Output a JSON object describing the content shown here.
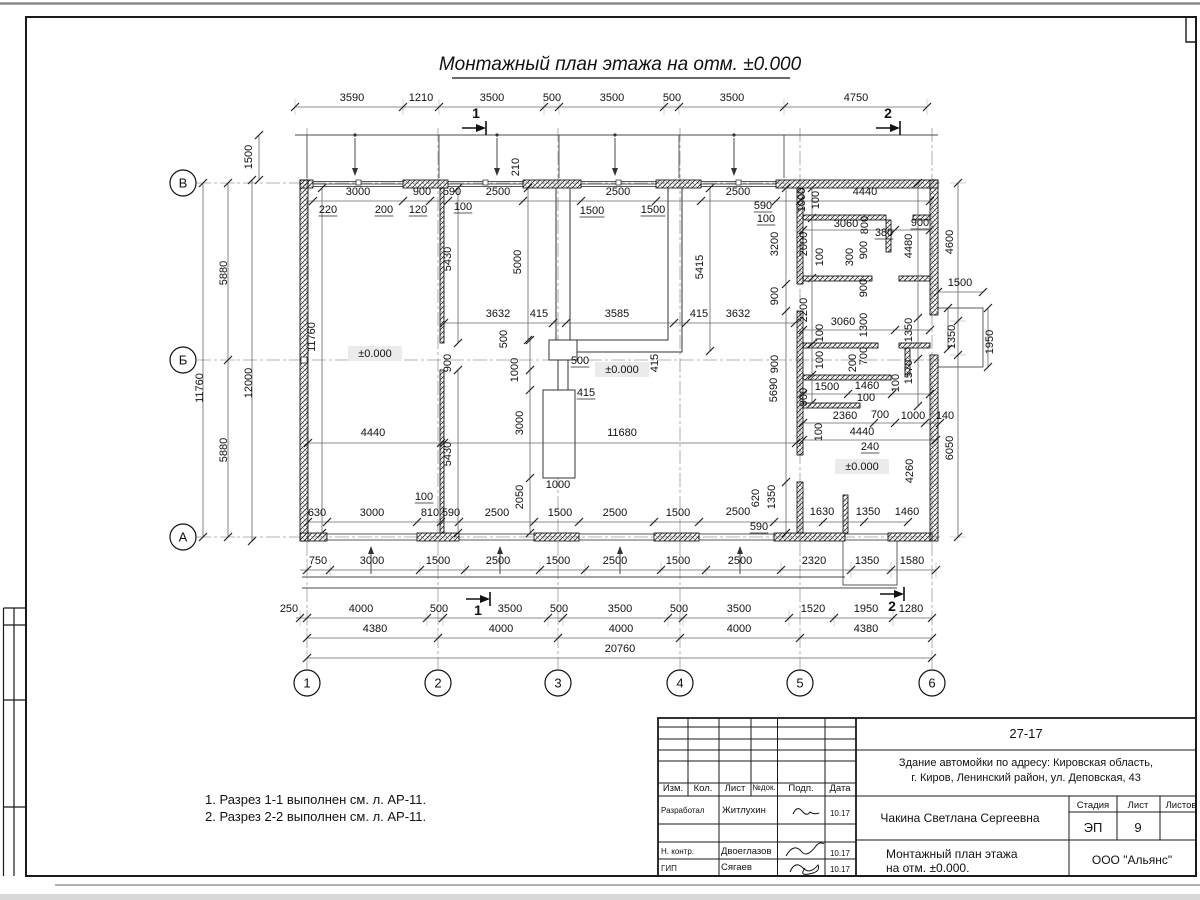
{
  "sheet": {
    "title": "Монтажный план этажа на отм. ±0.000",
    "notes": [
      "1. Разрез 1-1 выполнен см. л. АР-11.",
      "2. Разрез 2-2 выполнен см. л. АР-11."
    ]
  },
  "axes": {
    "rows": [
      {
        "label": "В",
        "x": 183,
        "y": 183
      },
      {
        "label": "Б",
        "x": 183,
        "y": 360
      },
      {
        "label": "А",
        "x": 183,
        "y": 537
      }
    ],
    "cols": [
      {
        "label": "1",
        "x": 307,
        "y": 683
      },
      {
        "label": "2",
        "x": 438,
        "y": 683
      },
      {
        "label": "3",
        "x": 558,
        "y": 683
      },
      {
        "label": "4",
        "x": 680,
        "y": 683
      },
      {
        "label": "5",
        "x": 800,
        "y": 683
      },
      {
        "label": "6",
        "x": 932,
        "y": 683
      }
    ]
  },
  "sections": [
    {
      "t": "1",
      "tx": 476,
      "ty": 118,
      "ax": 462,
      "ay": 128
    },
    {
      "t": "2",
      "tx": 888,
      "ty": 118,
      "ax": 876,
      "ay": 128
    },
    {
      "t": "1",
      "tx": 478,
      "ty": 615,
      "ax": 466,
      "ay": 599
    },
    {
      "t": "2",
      "tx": 892,
      "ty": 611,
      "ax": 880,
      "ay": 594
    }
  ],
  "levels": [
    {
      "t": "±0.000",
      "x": 375,
      "y": 357
    },
    {
      "t": "±0.000",
      "x": 622,
      "y": 373
    },
    {
      "t": "±0.000",
      "x": 862,
      "y": 470
    }
  ],
  "dims": [
    [
      "3590",
      352,
      101
    ],
    [
      "1210",
      421,
      101
    ],
    [
      "3500",
      492,
      101
    ],
    [
      "500",
      552,
      101
    ],
    [
      "3500",
      612,
      101
    ],
    [
      "500",
      672,
      101
    ],
    [
      "3500",
      732,
      101
    ],
    [
      "4750",
      856,
      101
    ],
    [
      "3000",
      358,
      195
    ],
    [
      "900",
      422,
      195
    ],
    [
      "590",
      452,
      195
    ],
    [
      "2500",
      498,
      195
    ],
    [
      "2500",
      618,
      195
    ],
    [
      "2500",
      738,
      195
    ],
    [
      "4440",
      865,
      195
    ],
    [
      "220",
      328,
      213,
      0,
      1
    ],
    [
      "200",
      384,
      213,
      0,
      1
    ],
    [
      "120",
      418,
      213,
      0,
      1
    ],
    [
      "100",
      463,
      210,
      0,
      1
    ],
    [
      "1500",
      592,
      214,
      0,
      1
    ],
    [
      "1500",
      653,
      213,
      0,
      1
    ],
    [
      "590",
      763,
      209,
      0,
      1
    ],
    [
      "100",
      766,
      222,
      0,
      1
    ],
    [
      "1000",
      805,
      200,
      1
    ],
    [
      "100",
      819,
      200,
      1
    ],
    [
      "3060",
      846,
      227
    ],
    [
      "800",
      868,
      225,
      1
    ],
    [
      "380",
      884,
      236,
      0,
      1
    ],
    [
      "900",
      920,
      226,
      0,
      1
    ],
    [
      "3200",
      778,
      244,
      1
    ],
    [
      "2000",
      807,
      244,
      1
    ],
    [
      "100",
      823,
      257,
      1
    ],
    [
      "300",
      853,
      257,
      1
    ],
    [
      "900",
      867,
      250,
      1
    ],
    [
      "4480",
      912,
      246,
      1
    ],
    [
      "4600",
      953,
      242,
      1
    ],
    [
      "900",
      778,
      296,
      1
    ],
    [
      "2200",
      807,
      310,
      1
    ],
    [
      "900",
      867,
      288,
      1
    ],
    [
      "1500",
      960,
      286
    ],
    [
      "3060",
      843,
      325
    ],
    [
      "1300",
      867,
      325,
      1
    ],
    [
      "100",
      823,
      333,
      1
    ],
    [
      "1350",
      912,
      330,
      1
    ],
    [
      "1350",
      955,
      337,
      1
    ],
    [
      "1950",
      993,
      342,
      1
    ],
    [
      "1570",
      912,
      372,
      1
    ],
    [
      "900",
      778,
      364,
      1
    ],
    [
      "100",
      823,
      360,
      1
    ],
    [
      "200",
      856,
      363,
      1
    ],
    [
      "700",
      867,
      356,
      1
    ],
    [
      "1500",
      827,
      390
    ],
    [
      "1460",
      867,
      389
    ],
    [
      "100",
      899,
      383,
      1
    ],
    [
      "100",
      866,
      401
    ],
    [
      "900",
      807,
      397,
      1
    ],
    [
      "5690",
      777,
      390,
      1
    ],
    [
      "2360",
      845,
      419
    ],
    [
      "700",
      880,
      418
    ],
    [
      "1000",
      913,
      419
    ],
    [
      "140",
      945,
      419
    ],
    [
      "100",
      822,
      432,
      1
    ],
    [
      "4440",
      862,
      435
    ],
    [
      "240",
      870,
      450,
      0,
      1
    ],
    [
      "4260",
      913,
      471,
      1
    ],
    [
      "6050",
      953,
      448,
      1
    ],
    [
      "620",
      759,
      498,
      1
    ],
    [
      "1350",
      775,
      497,
      1
    ],
    [
      "590",
      759,
      530,
      0,
      1
    ],
    [
      "2500",
      738,
      515
    ],
    [
      "1630",
      822,
      515
    ],
    [
      "1350",
      868,
      515
    ],
    [
      "1460",
      907,
      515
    ],
    [
      "1500",
      252,
      157,
      1
    ],
    [
      "5880",
      227,
      273,
      1
    ],
    [
      "11760",
      203,
      388,
      1
    ],
    [
      "12000",
      252,
      383,
      1
    ],
    [
      "5880",
      227,
      450,
      1
    ],
    [
      "11760",
      315,
      337,
      1
    ],
    [
      "210",
      519,
      167,
      1
    ],
    [
      "5430",
      451,
      259,
      1
    ],
    [
      "5000",
      521,
      262,
      1
    ],
    [
      "5415",
      703,
      267,
      1
    ],
    [
      "3632",
      498,
      317
    ],
    [
      "415",
      539,
      317
    ],
    [
      "3585",
      617,
      317
    ],
    [
      "415",
      699,
      317
    ],
    [
      "3632",
      738,
      317
    ],
    [
      "500",
      507,
      339,
      1
    ],
    [
      "500",
      580,
      364,
      0,
      1
    ],
    [
      "1000",
      518,
      370,
      1
    ],
    [
      "415",
      658,
      363,
      1
    ],
    [
      "900",
      451,
      363,
      1
    ],
    [
      "415",
      586,
      396,
      0,
      1
    ],
    [
      "3000",
      523,
      423,
      1
    ],
    [
      "4440",
      373,
      436
    ],
    [
      "11680",
      622,
      436
    ],
    [
      "5430",
      451,
      454,
      1
    ],
    [
      "2050",
      523,
      497,
      1
    ],
    [
      "1000",
      558,
      488
    ],
    [
      "100",
      424,
      500,
      0,
      1
    ],
    [
      "630",
      317,
      516
    ],
    [
      "3000",
      372,
      516
    ],
    [
      "810",
      430,
      516
    ],
    [
      "590",
      451,
      516
    ],
    [
      "2500",
      497,
      516
    ],
    [
      "1500",
      560,
      516
    ],
    [
      "2500",
      615,
      516
    ],
    [
      "1500",
      678,
      516
    ],
    [
      "750",
      318,
      564
    ],
    [
      "3000",
      372,
      564
    ],
    [
      "1500",
      438,
      564
    ],
    [
      "2500",
      498,
      564
    ],
    [
      "1500",
      558,
      564
    ],
    [
      "2500",
      615,
      564
    ],
    [
      "1500",
      678,
      564
    ],
    [
      "2500",
      740,
      564
    ],
    [
      "2320",
      814,
      564
    ],
    [
      "1350",
      867,
      564
    ],
    [
      "1580",
      912,
      564
    ],
    [
      "250",
      289,
      612
    ],
    [
      "4000",
      361,
      612
    ],
    [
      "500",
      439,
      612
    ],
    [
      "3500",
      510,
      612
    ],
    [
      "500",
      559,
      612
    ],
    [
      "3500",
      620,
      612
    ],
    [
      "500",
      679,
      612
    ],
    [
      "3500",
      739,
      612
    ],
    [
      "1520",
      813,
      612
    ],
    [
      "1950",
      866,
      612
    ],
    [
      "1280",
      911,
      612
    ],
    [
      "4380",
      375,
      632
    ],
    [
      "4000",
      501,
      632
    ],
    [
      "4000",
      621,
      632
    ],
    [
      "4000",
      739,
      632
    ],
    [
      "4380",
      866,
      632
    ],
    [
      "20760",
      620,
      652
    ]
  ],
  "chains": {
    "h": [
      {
        "y": 107,
        "x1": 295,
        "x2": 927,
        "t": [
          295,
          403,
          439,
          544,
          559,
          664,
          679,
          784,
          927
        ],
        "e": 1
      },
      {
        "y": 201,
        "x1": 308,
        "x2": 930,
        "t": [
          313,
          403,
          430,
          448,
          523,
          581,
          656,
          701,
          776,
          800,
          930
        ]
      },
      {
        "y": 323,
        "x1": 444,
        "x2": 795,
        "t": [
          444,
          553,
          566,
          674,
          686,
          795
        ]
      },
      {
        "y": 443,
        "x1": 308,
        "x2": 796,
        "t": [
          308,
          441,
          444,
          796
        ]
      },
      {
        "y": 522,
        "x1": 308,
        "x2": 908,
        "t": [
          308,
          327,
          417,
          441,
          459,
          534,
          579,
          654,
          699,
          774,
          823,
          864,
          908
        ]
      },
      {
        "y": 570,
        "x1": 300,
        "x2": 936,
        "t": [
          307,
          330,
          420,
          465,
          540,
          585,
          661,
          706,
          781,
          851,
          891,
          936
        ],
        "e": 1
      },
      {
        "y": 618,
        "x1": 296,
        "x2": 932,
        "t": [
          300,
          307,
          427,
          443,
          548,
          563,
          668,
          683,
          789,
          834,
          893,
          932
        ],
        "e": 1
      },
      {
        "y": 638,
        "x1": 307,
        "x2": 932,
        "t": [
          307,
          438,
          558,
          680,
          800,
          932
        ],
        "e": 1
      },
      {
        "y": 658,
        "x1": 307,
        "x2": 932,
        "t": [
          307,
          932
        ],
        "e": 1
      },
      {
        "y": 292,
        "x1": 938,
        "x2": 983,
        "t": [
          938,
          983
        ]
      },
      {
        "y": 230,
        "x1": 803,
        "x2": 930,
        "t": [
          803,
          895,
          930
        ]
      },
      {
        "y": 330,
        "x1": 803,
        "x2": 930,
        "t": [
          803,
          895,
          930
        ]
      },
      {
        "y": 394,
        "x1": 803,
        "x2": 930,
        "t": [
          803,
          848,
          892,
          930
        ]
      },
      {
        "y": 423,
        "x1": 803,
        "x2": 940,
        "t": [
          803,
          874,
          895,
          925,
          940
        ]
      },
      {
        "y": 440,
        "x1": 803,
        "x2": 936,
        "t": [
          803,
          936
        ]
      }
    ],
    "v": [
      {
        "x": 203,
        "y1": 183,
        "y2": 537,
        "t": [
          183,
          537
        ],
        "e": 1
      },
      {
        "x": 228,
        "y1": 183,
        "y2": 537,
        "t": [
          183,
          360,
          537
        ],
        "e": 1
      },
      {
        "x": 252,
        "y1": 180,
        "y2": 541,
        "t": [
          180,
          541
        ]
      },
      {
        "x": 259,
        "y1": 135,
        "y2": 180,
        "t": [
          135,
          180
        ]
      },
      {
        "x": 322,
        "y1": 188,
        "y2": 533,
        "t": [
          188,
          533
        ]
      },
      {
        "x": 458,
        "y1": 188,
        "y2": 343,
        "t": [
          188,
          343
        ]
      },
      {
        "x": 458,
        "y1": 370,
        "y2": 533,
        "t": [
          370,
          533
        ]
      },
      {
        "x": 528,
        "y1": 188,
        "y2": 340,
        "t": [
          188,
          340
        ]
      },
      {
        "x": 710,
        "y1": 188,
        "y2": 351,
        "t": [
          188,
          351
        ]
      },
      {
        "x": 530,
        "y1": 340,
        "y2": 533,
        "t": [
          340,
          370,
          390,
          478,
          533
        ]
      },
      {
        "x": 786,
        "y1": 188,
        "y2": 533,
        "t": [
          188,
          284,
          311,
          482,
          533
        ]
      },
      {
        "x": 812,
        "y1": 188,
        "y2": 403,
        "t": [
          188,
          218,
          278,
          344,
          375,
          403
        ]
      },
      {
        "x": 918,
        "y1": 183,
        "y2": 406,
        "t": [
          183,
          318,
          359,
          406
        ]
      },
      {
        "x": 958,
        "y1": 183,
        "y2": 537,
        "t": [
          183,
          321,
          355,
          537
        ],
        "e": 1
      },
      {
        "x": 988,
        "y1": 308,
        "y2": 367,
        "t": [
          308,
          367
        ]
      },
      {
        "x": 948,
        "y1": 308,
        "y2": 349,
        "t": [
          308,
          349
        ]
      }
    ]
  },
  "titleblock": {
    "doc_number": "27-17",
    "project_line1": "Здание автомойки по адресу: Кировская область,",
    "project_line2": "г. Киров, Ленинский район, ул. Деповская, 43",
    "col_izm": "Изм.",
    "col_kol": "Кол.",
    "col_list": "Лист",
    "col_ndok": "№док.",
    "col_podp": "Подп.",
    "col_data": "Дата",
    "row1_role": "Разработал",
    "row1_name": "Житлухин",
    "row1_date": "10.17",
    "row2_role": "Н. контр.",
    "row2_name": "Двоеглазов",
    "row2_date": "10.17",
    "row3_role": "ГИП",
    "row3_name": "Сягаев",
    "row3_date": "10.17",
    "author": "Чакина Светлана Сергеевна",
    "stage_label": "Стадия",
    "sheet_label": "Лист",
    "sheets_label": "Листов",
    "stage": "ЭП",
    "sheet_num": "9",
    "drawing_title_line1": "Монтажный план этажа",
    "drawing_title_line2": "на отм. ±0.000.",
    "company": "ООО \"Альянс\""
  }
}
